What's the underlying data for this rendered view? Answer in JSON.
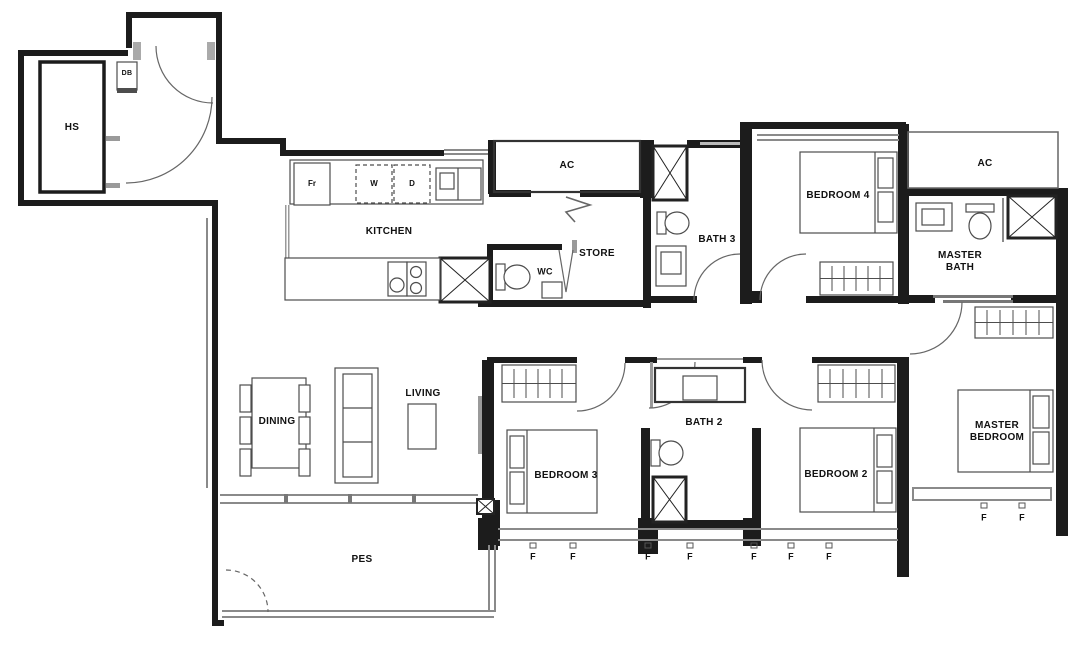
{
  "floor_plan": {
    "rooms": {
      "hs": {
        "label": "HS"
      },
      "kitchen": {
        "label": "KITCHEN"
      },
      "store": {
        "label": "STORE"
      },
      "wc": {
        "label": "WC"
      },
      "bath3": {
        "label": "BATH 3"
      },
      "bedroom4": {
        "label": "BEDROOM 4"
      },
      "master_bath": {
        "label": "MASTER BATH"
      },
      "dining": {
        "label": "DINING"
      },
      "living": {
        "label": "LIVING"
      },
      "bedroom3": {
        "label": "BEDROOM 3"
      },
      "bath2": {
        "label": "BATH 2"
      },
      "bedroom2": {
        "label": "BEDROOM 2"
      },
      "master_bedroom": {
        "label": "MASTER BEDROOM"
      },
      "pes": {
        "label": "PES"
      },
      "ac_left": {
        "label": "AC"
      },
      "ac_right": {
        "label": "AC"
      }
    },
    "fixtures": {
      "distribution_board": "DB",
      "fridge": "Fr",
      "washer": "W",
      "dryer": "D"
    },
    "window_marker": "F",
    "colors": {
      "wall": "#1c1c1c",
      "furniture_line": "#4d4d4d",
      "thin_line": "#8a8a8a",
      "background": "#ffffff"
    }
  }
}
